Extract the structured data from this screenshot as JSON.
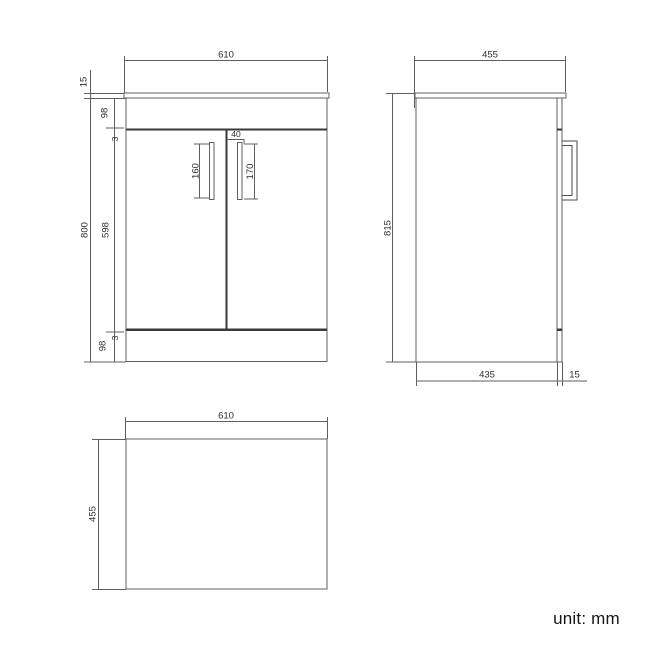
{
  "front_view": {
    "width_mm": "610",
    "countertop_thickness_mm": "15",
    "cabinet_height_mm": "800",
    "top_panel_mm": "98",
    "top_gap_mm": "3",
    "door_height_mm": "598",
    "bottom_gap_mm": "3",
    "bottom_panel_mm": "98",
    "left_handle_mm": "160",
    "right_handle_mm": "170",
    "handle_offset_mm": "40"
  },
  "side_view": {
    "depth_mm": "455",
    "overall_height_mm": "815",
    "base_depth_mm": "435",
    "door_thickness_mm": "15"
  },
  "top_view": {
    "width_mm": "610",
    "depth_mm": "455"
  },
  "footer": {
    "unit_label": "unit: mm"
  },
  "colors": {
    "line": "#5f5f5f",
    "line_dark": "#3a3a3a",
    "text": "#2e2e2e",
    "background": "#ffffff"
  }
}
